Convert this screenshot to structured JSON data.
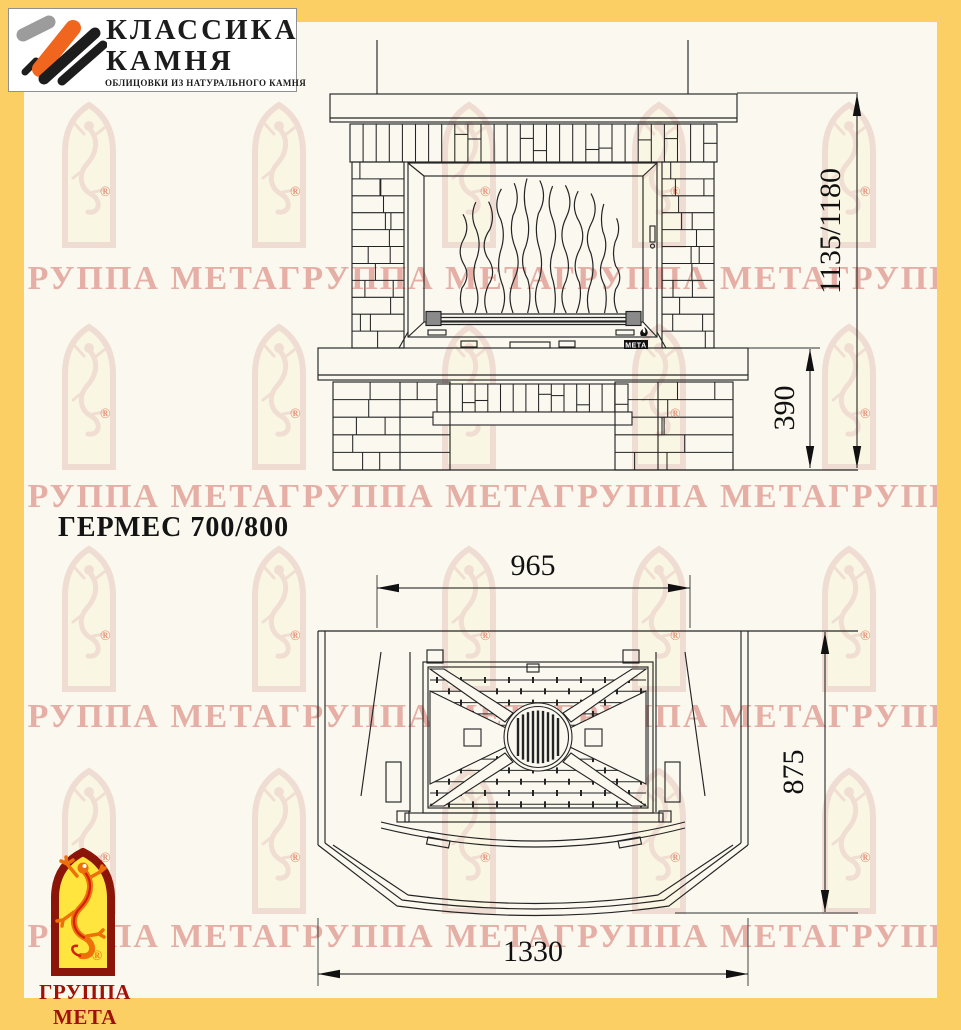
{
  "header_logo": {
    "line1": "КЛАССИКА",
    "line2": "КАМНЯ",
    "subtitle": "ОБЛИЦОВКИ ИЗ НАТУРАЛЬНОГО КАМНЯ"
  },
  "drawing": {
    "title": "ГЕРМЕС 700/800",
    "front_view": {
      "height_dim": "1135/1180",
      "base_height_dim": "390",
      "door_brand": "МЕТА"
    },
    "plan_view": {
      "firebox_width_dim": "965",
      "depth_dim": "875",
      "base_width_dim": "1330"
    }
  },
  "footer_logo": {
    "brand": "ГРУППА МЕТА",
    "registered_mark": "®"
  },
  "watermark": {
    "row_text": "ГРУППА МЕТАГРУППА МЕТАГРУППА МЕТАГРУППА МЕТАГРУППА МЕТА",
    "registered_mark": "®"
  },
  "colors": {
    "frame": "#fbcf63",
    "paper": "#faf8ef",
    "line": "#242424",
    "logo_red": "#a01208",
    "logo_yellow": "#ffe53e",
    "logo_orange": "#ee7008"
  }
}
